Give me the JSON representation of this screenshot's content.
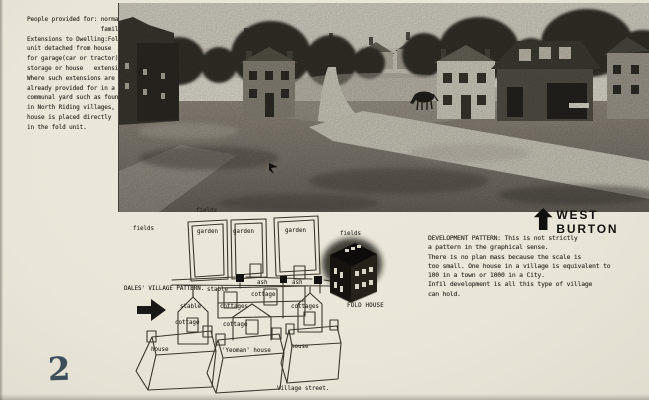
{
  "page": {
    "number": "2"
  },
  "notes": {
    "margin_note": "People provided for: normal\n                     family\nExtensions to Dwelling:Fold\nunit detached from house\nfor garage(car or tractor),\nstorage or house   extension.\nWhere such extensions are\nalready provided for in a\ncommunal yard such as found\nin North Riding villages,\nhouse is placed directly\nin the fold unit.",
    "development_note": "DEVELOPMENT PATTERN: This is not strictly\na pattern in the graphical sense.\nThere is no plan mass because the scale is\ntoo small. One house in a village is equivalent to\n100 in a town or 1000 in a City.\nInfil development is all this type of village\ncan hold."
  },
  "headings": {
    "village_name": "WEST BURTON",
    "pattern_title": "DALES' VILLAGE PATTERN."
  },
  "plan_labels": {
    "fields_top": "fields",
    "fields_left": "fields",
    "fields_right": "fields",
    "garden_1": "garden",
    "garden_2": "garden",
    "garden_3": "garden",
    "stable_left": "stable",
    "cottage_left": "cottage",
    "stable_mid": "stable",
    "ash_left": "ash",
    "ash_right": "ash",
    "cottage_mid": "cottage",
    "cottages_mid": "cottages",
    "cottages_right": "cottages",
    "cottage_lower": "cottage",
    "house_left": "house",
    "yeoman_house": "'Yeoman' house",
    "house_right": "house",
    "fold_house": "FOLD HOUSE",
    "village_street": "Village street."
  },
  "icons": {
    "pattern_arrow": "right-arrow",
    "village_arrow": "up-arrow"
  },
  "colors": {
    "page_bg": "#eae6da",
    "ink": "#2b2720",
    "page_number_ink": "#3e4e58"
  }
}
